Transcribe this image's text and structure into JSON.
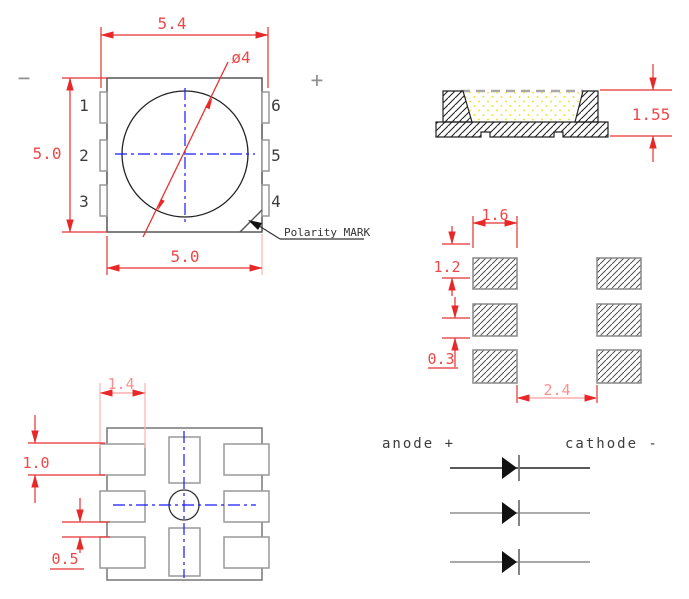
{
  "top_view": {
    "dim_overall_width": "5.4",
    "dim_body_width": "5.0",
    "dim_body_height": "5.0",
    "dim_lens_diameter": "ø4",
    "pin_labels_left": [
      "1",
      "2",
      "3"
    ],
    "pin_labels_right": [
      "6",
      "5",
      "4"
    ],
    "minus_symbol": "−",
    "plus_symbol": "+",
    "polarity_label": "Polarity MARK"
  },
  "side_view": {
    "dim_total_height": "1.55"
  },
  "solder_pad_layout": {
    "dim_pad_width": "1.6",
    "dim_pad_height": "1.2",
    "dim_pad_gap": "0.3",
    "dim_column_gap": "2.4"
  },
  "bottom_view": {
    "dim_pad_width": "1.4",
    "dim_pad_height": "1.0",
    "dim_pad_gap": "0.5"
  },
  "schematic": {
    "anode_label": "anode +",
    "cathode_label": "cathode -"
  },
  "colors": {
    "dimension_red": "#f03030",
    "dimension_pink": "#ffb0b0",
    "centerline_blue": "#1818ff",
    "outline_gray": "#888888",
    "body_outline": "#555555",
    "encapsulant_yellow": "#efe23a",
    "hatch_black": "#1a1a1a"
  }
}
